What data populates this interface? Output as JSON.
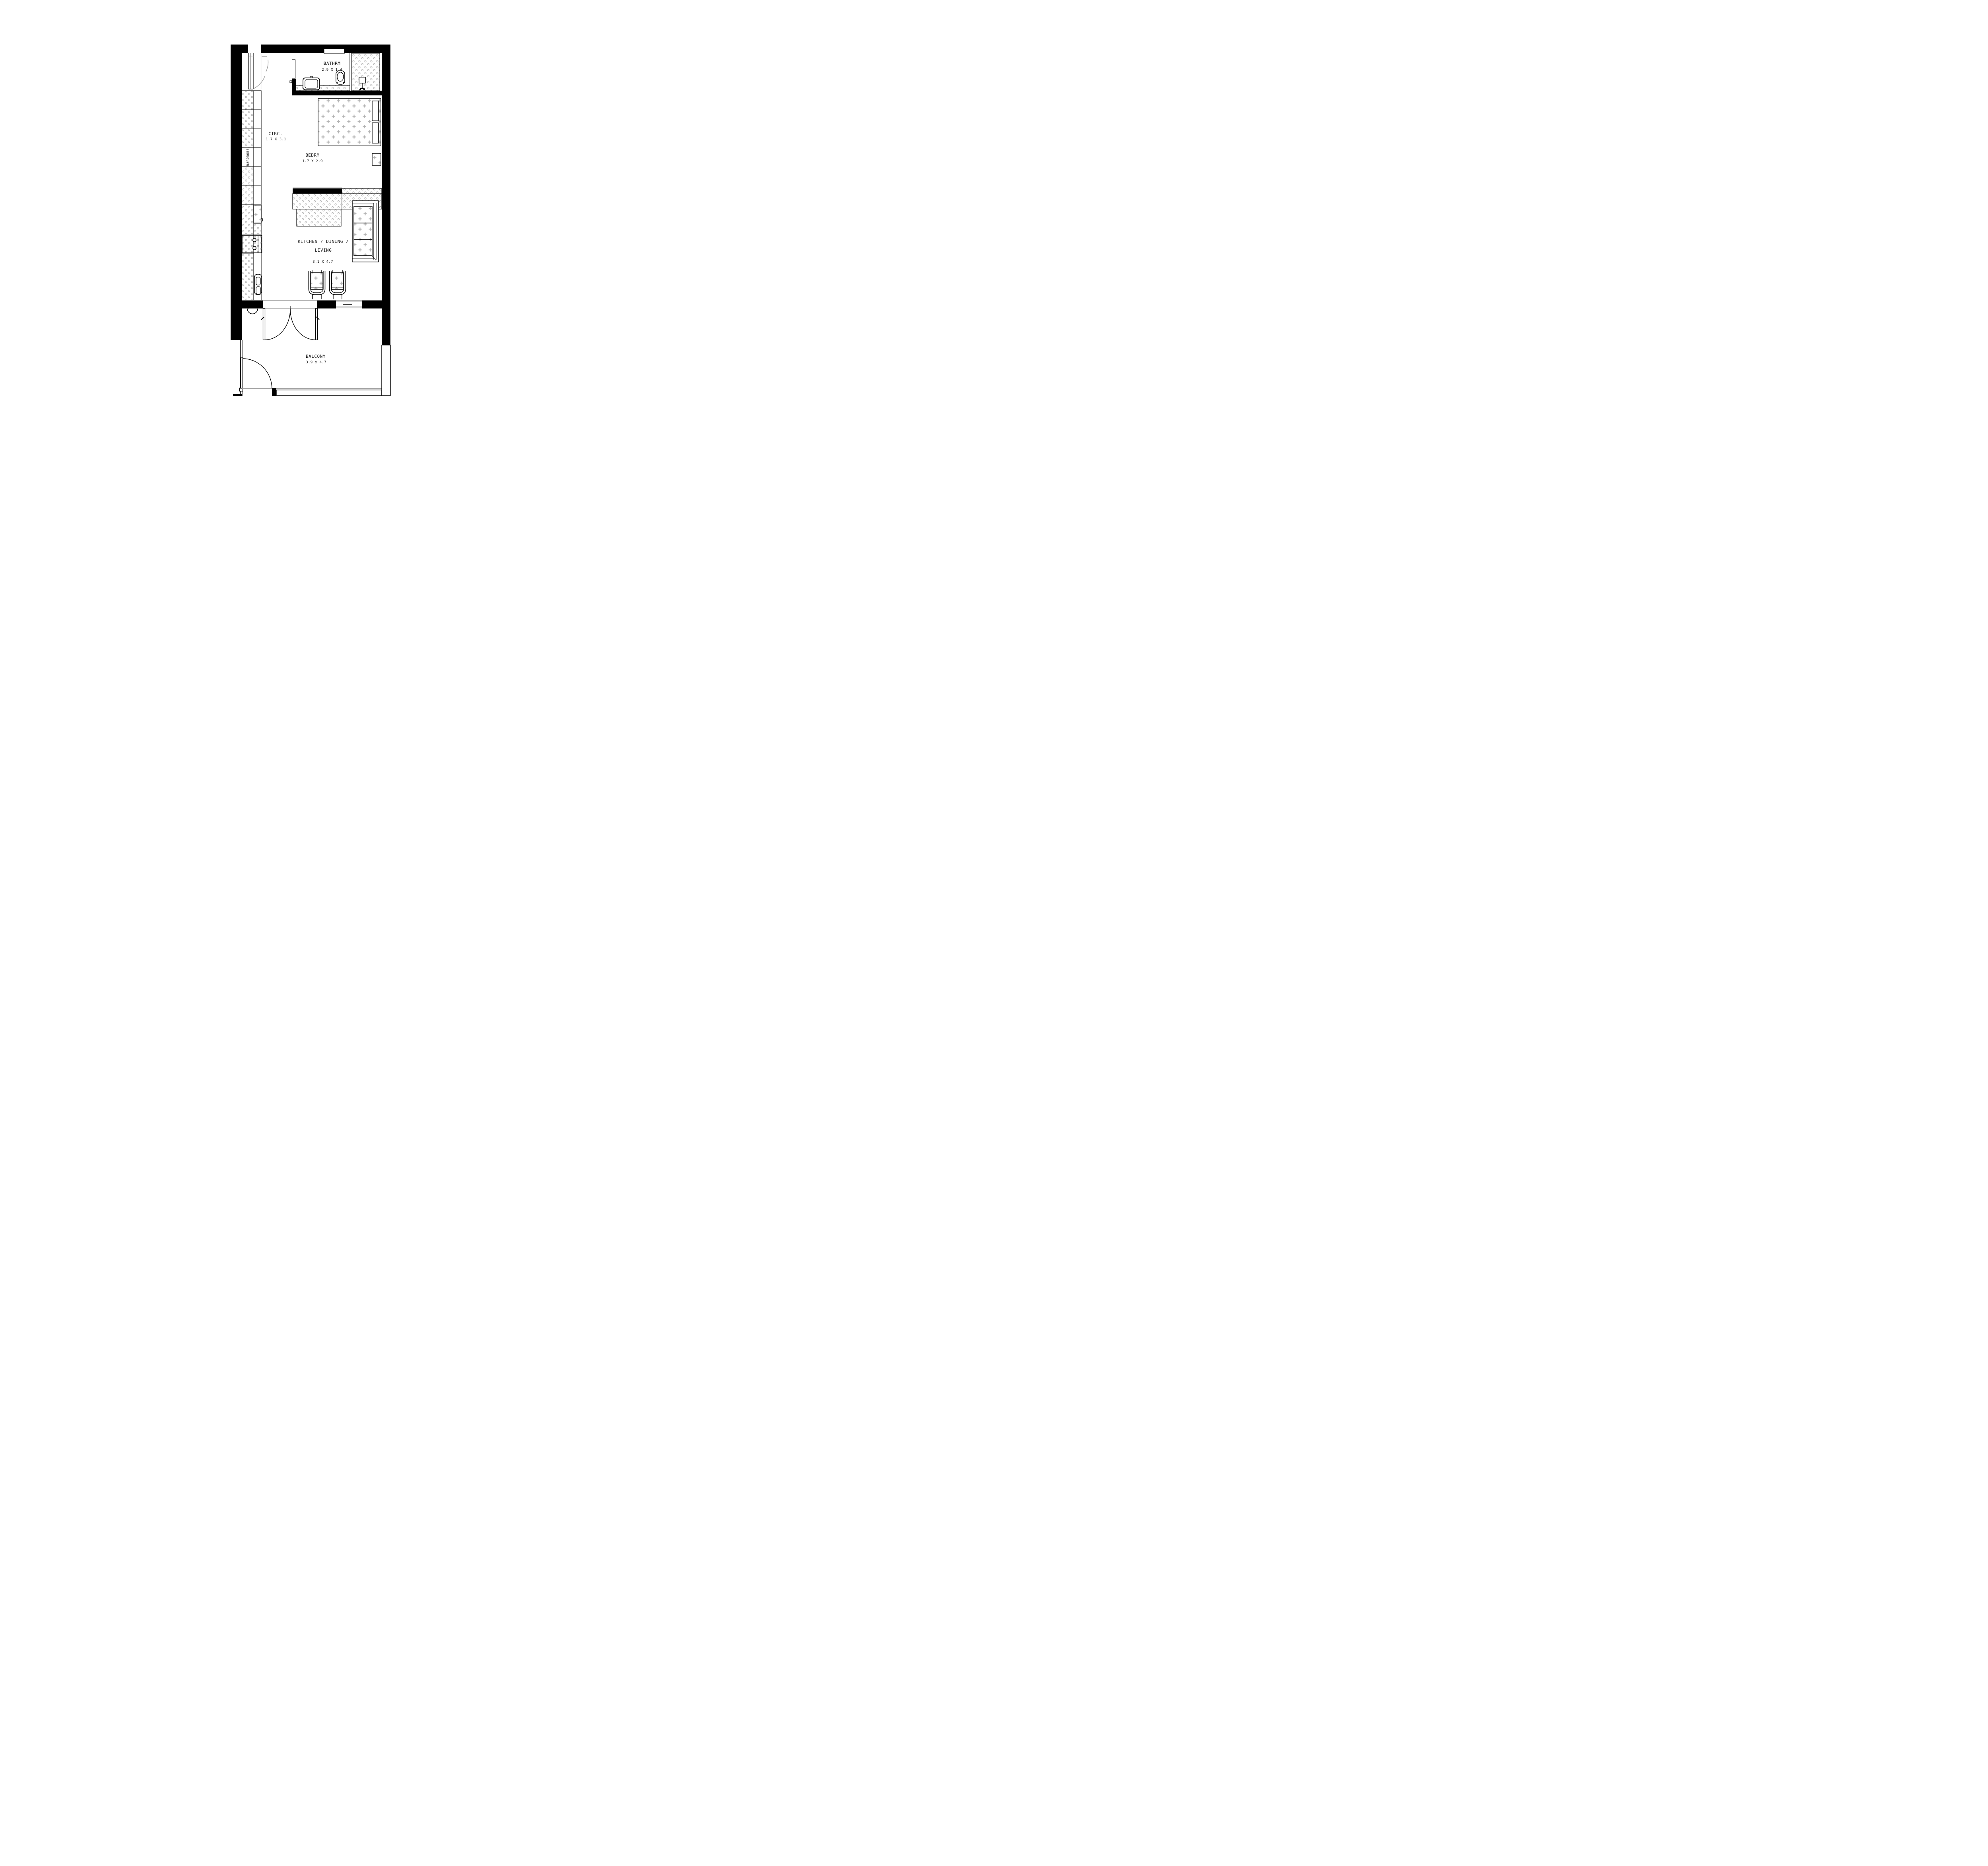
{
  "drawing_type": "apartment floor plan",
  "rooms": {
    "bathroom": {
      "name": "BATHRM",
      "dims": "2.9 X 1.4"
    },
    "circulation": {
      "name": "CIRC.",
      "dims": "1.7 X 3.1"
    },
    "bedroom": {
      "name": "BEDRM",
      "dims": "1.7 X 2.9"
    },
    "living": {
      "name_line1": "KITCHEN / DINING /",
      "name_line2": "LIVING",
      "dims": "3.1 X 4.7"
    },
    "balcony": {
      "name": "BALCONY",
      "dims": "3.9 x 4.7"
    },
    "wardrobe": {
      "label": "WARDROBE"
    }
  },
  "colors": {
    "wall": "#000000",
    "paper": "#ffffff",
    "pattern_gray": "#b3b3b3",
    "thin_gray_line": "#999999",
    "text": "#111111"
  }
}
